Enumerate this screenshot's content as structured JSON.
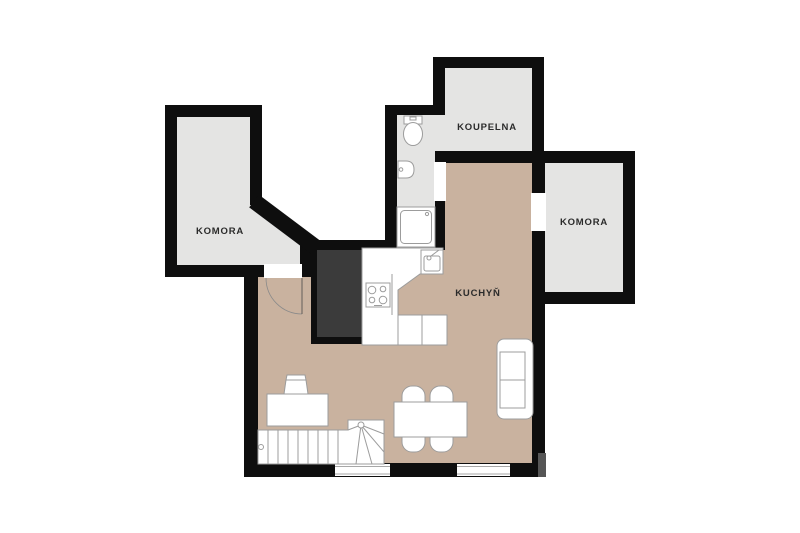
{
  "floorplan": {
    "title": "apartment-floor-plan",
    "labels": {
      "komora_left": "KOMORA",
      "koupelna": "KOUPELNA",
      "komora_right": "KOMORA",
      "kuchyn": "KUCHYŇ"
    },
    "colors": {
      "wall": "#0e0e0e",
      "room_floor_gray": "#e4e4e3",
      "kitchen_floor_tan": "#c9b29f",
      "shaft_fill": "#3b3b3b",
      "furniture_outline": "#9c9c9c",
      "label_text": "#2b2b2b",
      "background": "#ffffff"
    },
    "fixtures": [
      "toilet",
      "washbasin",
      "shower",
      "kitchen-sink",
      "stove",
      "kitchen-counter",
      "dining-table",
      "dining-chairs",
      "sofa",
      "desk",
      "desk-chair",
      "stairs",
      "door-arc",
      "window",
      "utility-shaft"
    ]
  }
}
